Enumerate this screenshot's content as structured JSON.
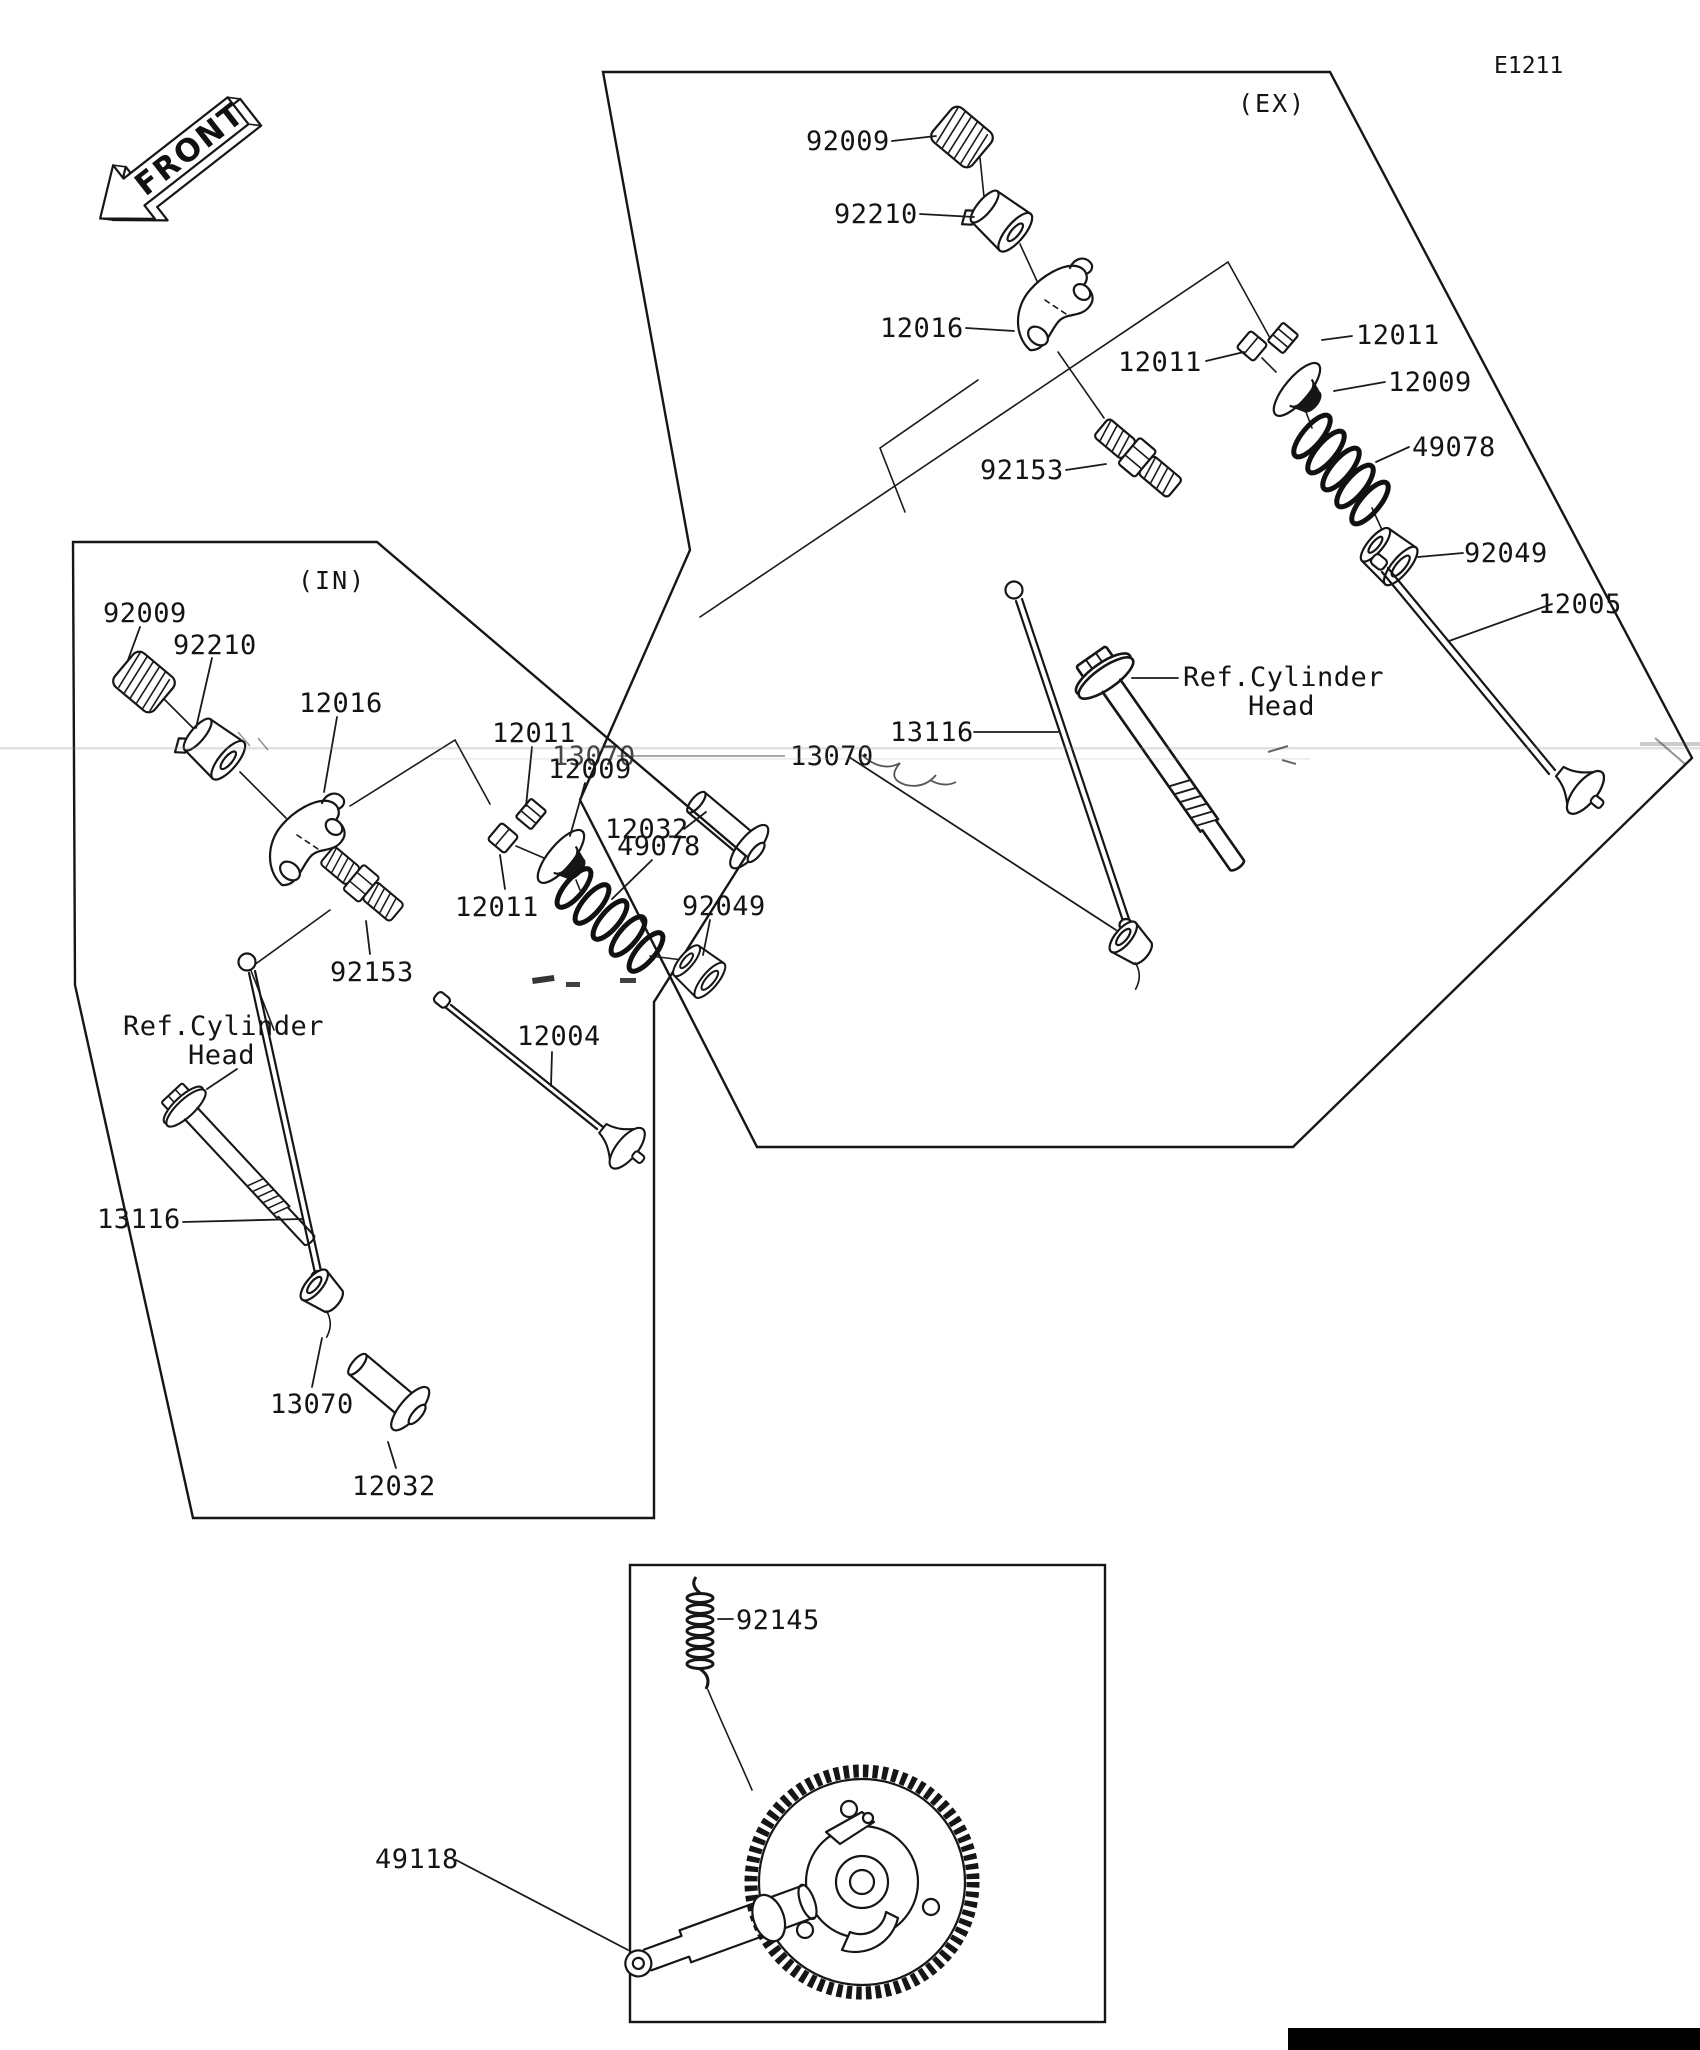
{
  "page_code": "E1211",
  "front_marker": "FRONT",
  "ex_box": {
    "tag": "(EX)",
    "labels": {
      "l92009": "92009",
      "l92210": "92210",
      "l12016": "12016",
      "l12011_left": "12011",
      "l12011_right": "12011",
      "l12009": "12009",
      "l49078": "49078",
      "l92049": "92049",
      "l12005": "12005",
      "l92153": "92153",
      "l13116": "13116",
      "ref_line1": "Ref.Cylinder",
      "ref_line2": "Head",
      "l13070": "13070",
      "l12032": "12032"
    }
  },
  "in_box": {
    "tag": "(IN)",
    "labels": {
      "l92009": "92009",
      "l92210": "92210",
      "l12016": "12016",
      "l12011_top": "12011",
      "l12009": "12009",
      "l49078": "49078",
      "l92049": "92049",
      "l12011_bottom": "12011",
      "l92153": "92153",
      "l12004": "12004",
      "ref_line1": "Ref.Cylinder",
      "ref_line2": "Head",
      "l13116": "13116",
      "l13070": "13070",
      "l12032": "12032"
    }
  },
  "camshaft_box": {
    "l92145": "92145",
    "l49118": "49118"
  },
  "artifacts": {
    "ghost_13070": "13070"
  }
}
